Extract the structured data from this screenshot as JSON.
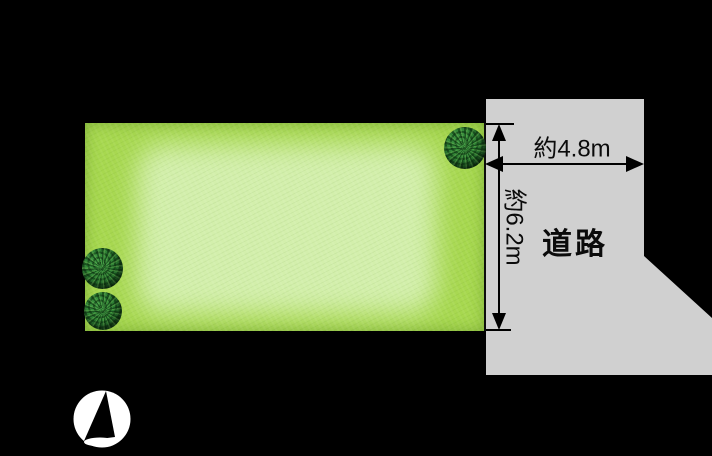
{
  "site_plan": {
    "road": {
      "label": "道路"
    },
    "dimensions": {
      "frontage_width": "約4.8m",
      "side_depth": "約6.2m"
    },
    "colors": {
      "background": "#000000",
      "road_fill": "#d0d0d0",
      "plot_green_edge": "#a7d84f",
      "plot_green_center": "#d3efac",
      "tree_green_dark": "#16481c",
      "tree_green_mid": "#2e8034",
      "dimension_line": "#000000",
      "compass_fill": "#ffffff"
    },
    "icons": {
      "compass": "north-compass-icon",
      "tree": "tree-icon"
    }
  }
}
